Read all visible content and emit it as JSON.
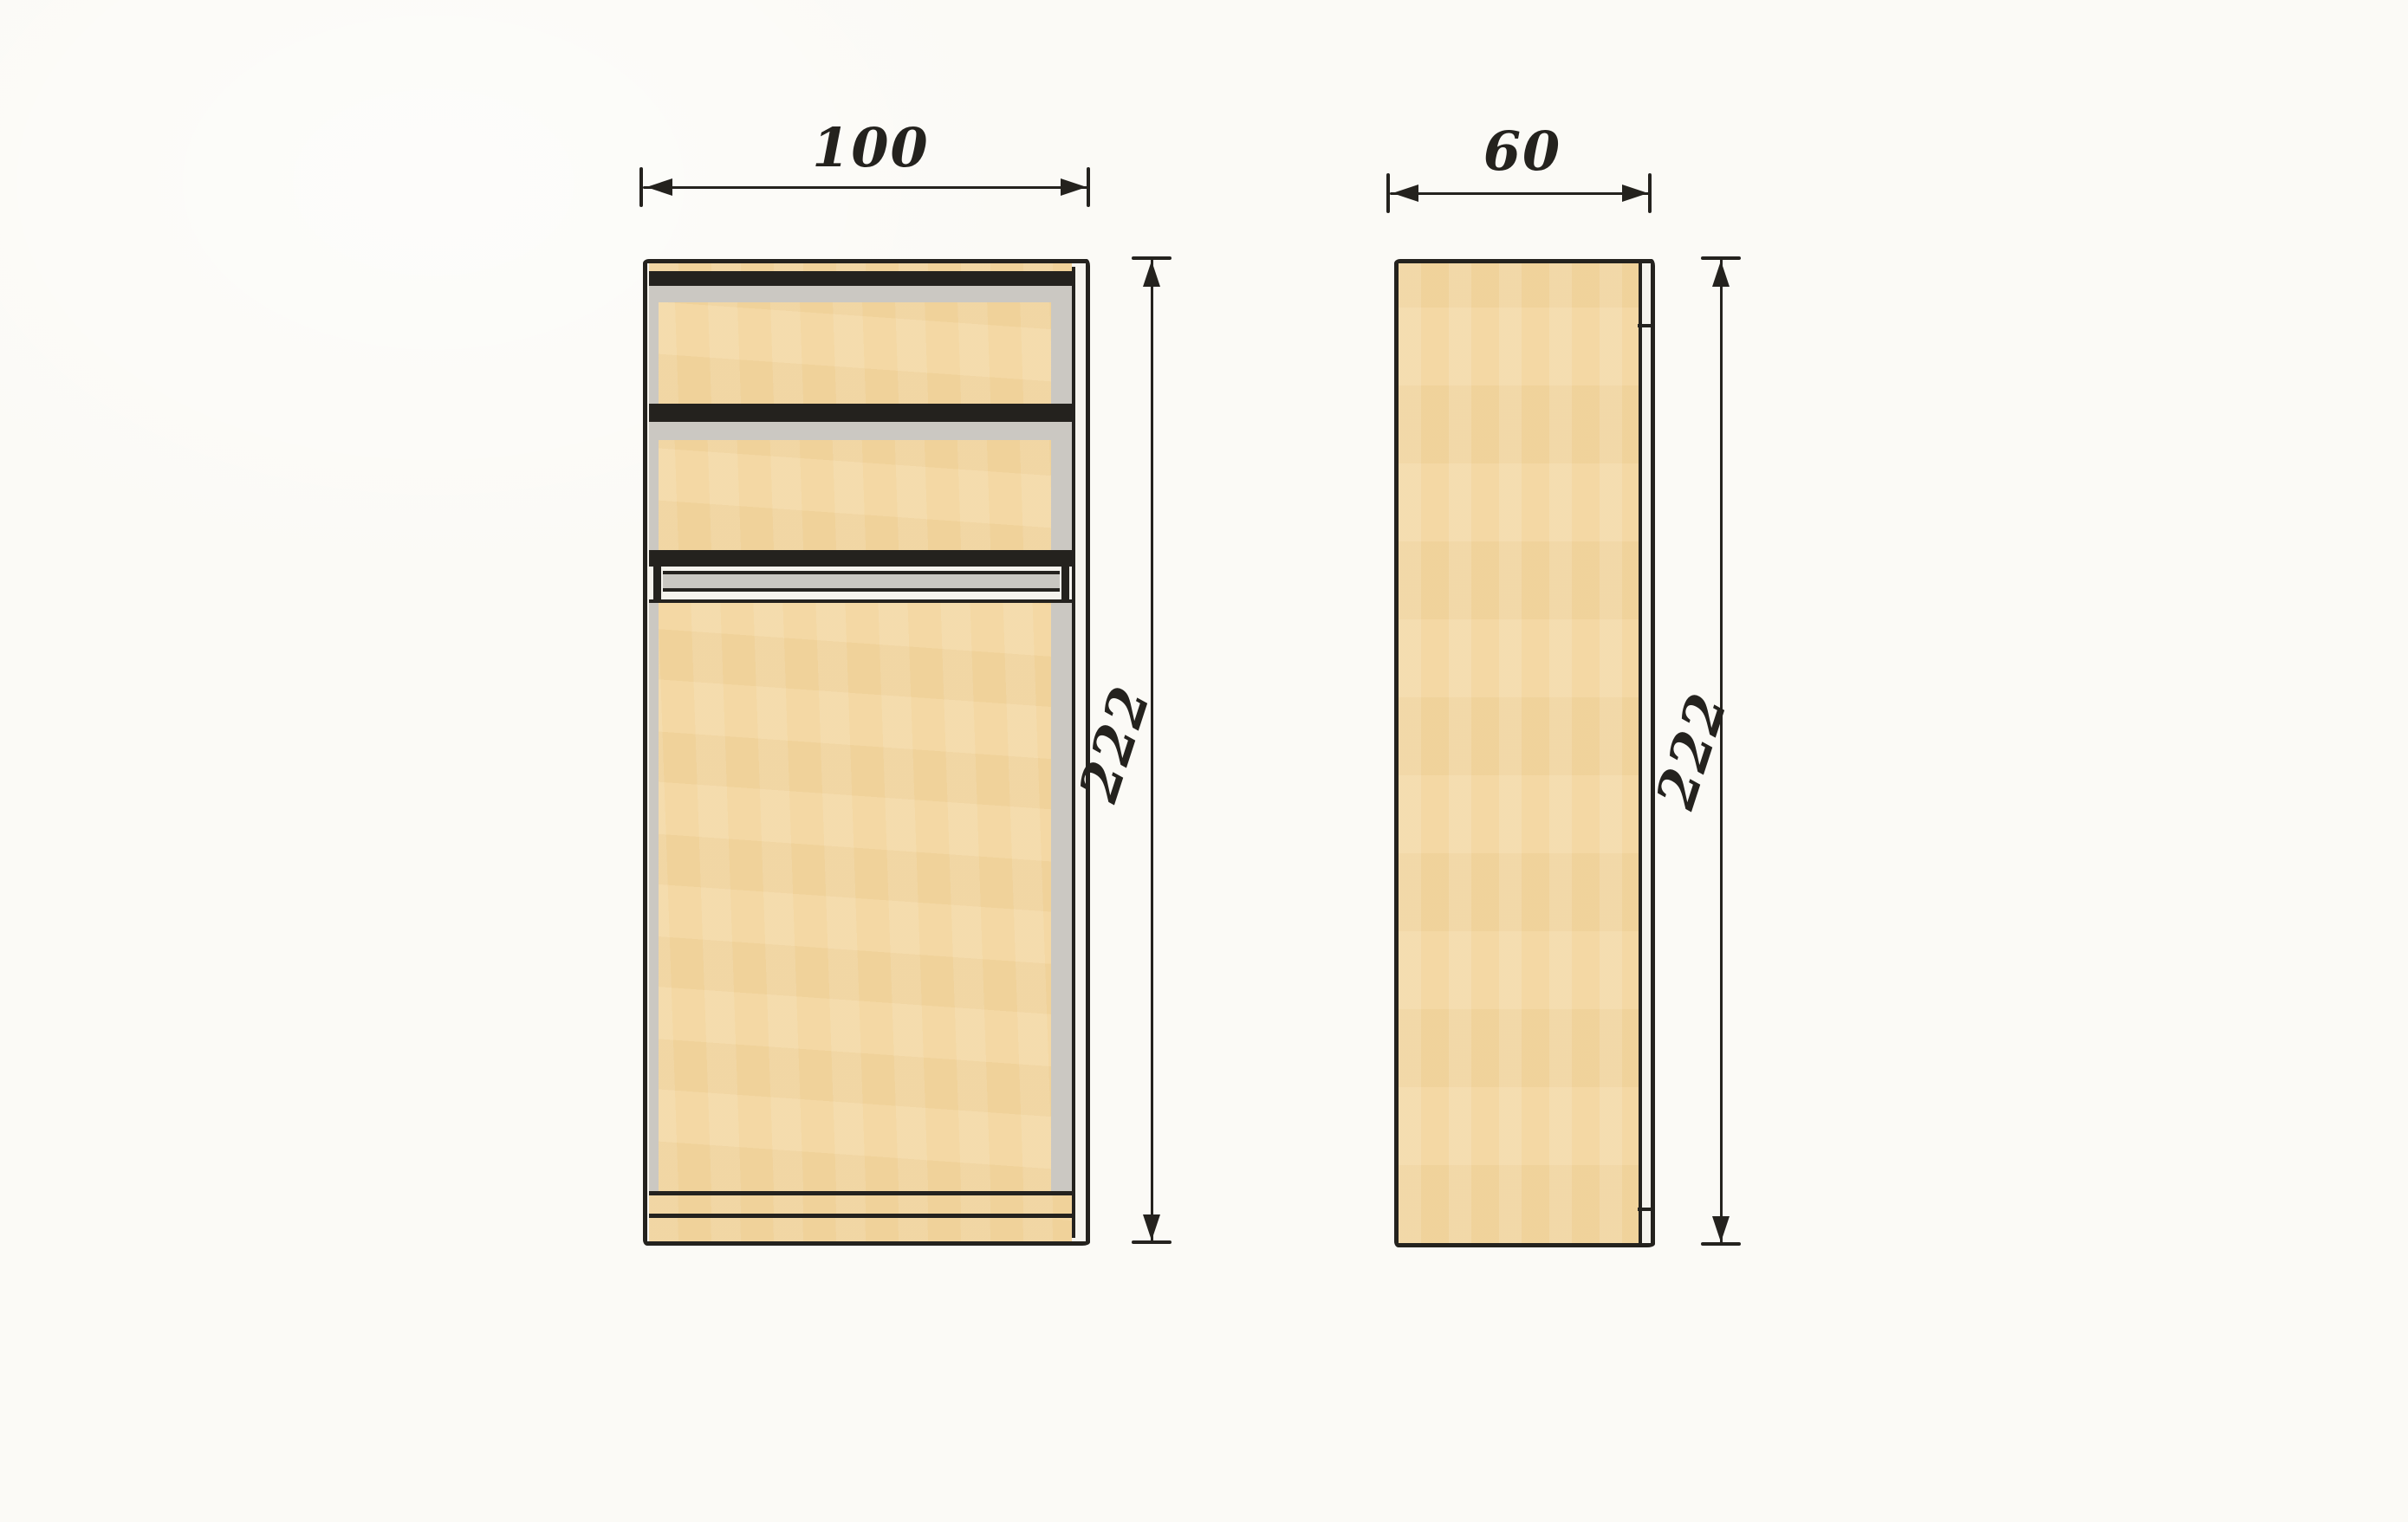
{
  "front_view": {
    "width_label": "100",
    "height_label": "222"
  },
  "side_view": {
    "width_label": "60",
    "height_label": "222"
  },
  "palette": {
    "paper": "#fbfaf6",
    "wood": "#f3d69f",
    "shadow": "#cbc8c2",
    "ink": "#24221e",
    "rail_gray": "#c9c7c1"
  }
}
